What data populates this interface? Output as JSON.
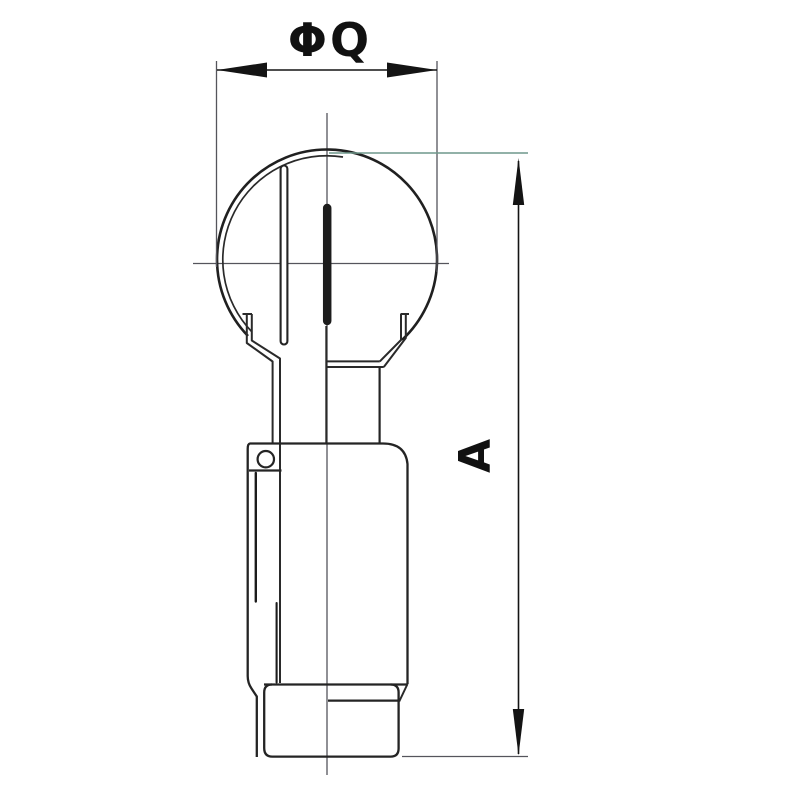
{
  "drawing": {
    "description": "Technical line drawing of a rotary spray ball (tank cleaning nozzle) with clip retainer, front view with dimension callouts",
    "labels": {
      "diameter": "ΦQ",
      "height": "A"
    },
    "colors": {
      "background": "#ffffff",
      "ink": "#242424",
      "dimension_ink": "#141414",
      "construction_line": "#55555c",
      "tinted_construction_line": "#6f978b"
    }
  }
}
